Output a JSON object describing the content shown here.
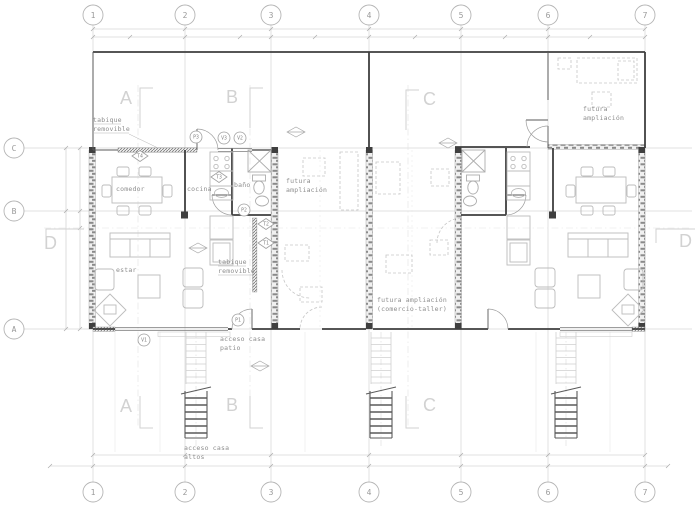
{
  "drawing_title": "planta arquitectónica",
  "colors": {
    "background": "#ffffff",
    "wall_dark": "#3f3f3f",
    "wall_hatch": "#8a8a8a",
    "grid": "#d6d6d6",
    "dimension": "#bfbfbf",
    "furniture": "#bcbcbc",
    "future_dashed": "#c6c6c6",
    "label_text": "#8d8d8d",
    "section_letter": "#d2d2d2",
    "tag_stroke": "#9f9f9f"
  },
  "axes": {
    "columns": [
      "1",
      "2",
      "3",
      "4",
      "5",
      "6",
      "7"
    ],
    "rows": [
      "C",
      "B",
      "A"
    ]
  },
  "sections": {
    "a": "A",
    "b": "B",
    "c": "C",
    "d": "D"
  },
  "rooms": {
    "comedor": "comedor",
    "cocina": "cocina",
    "bano": "baño",
    "estar": "estar"
  },
  "notes": {
    "tabique_removible": [
      "tabique",
      "removible"
    ],
    "futura_ampliacion": [
      "futura",
      "ampliación"
    ],
    "futura_comercio": [
      "futura ampliación",
      "(comercio-taller)"
    ],
    "acceso_patio": [
      "acceso casa",
      "patio"
    ],
    "acceso_altos": [
      "acceso casa",
      "altos"
    ]
  },
  "tags": {
    "p1": "P1",
    "p2": "P2",
    "p3": "P3",
    "v1": "V1",
    "v2": "V2",
    "v3": "V3",
    "t1": "T1",
    "t2": "T2",
    "t3": "T3",
    "t4": "T4"
  }
}
